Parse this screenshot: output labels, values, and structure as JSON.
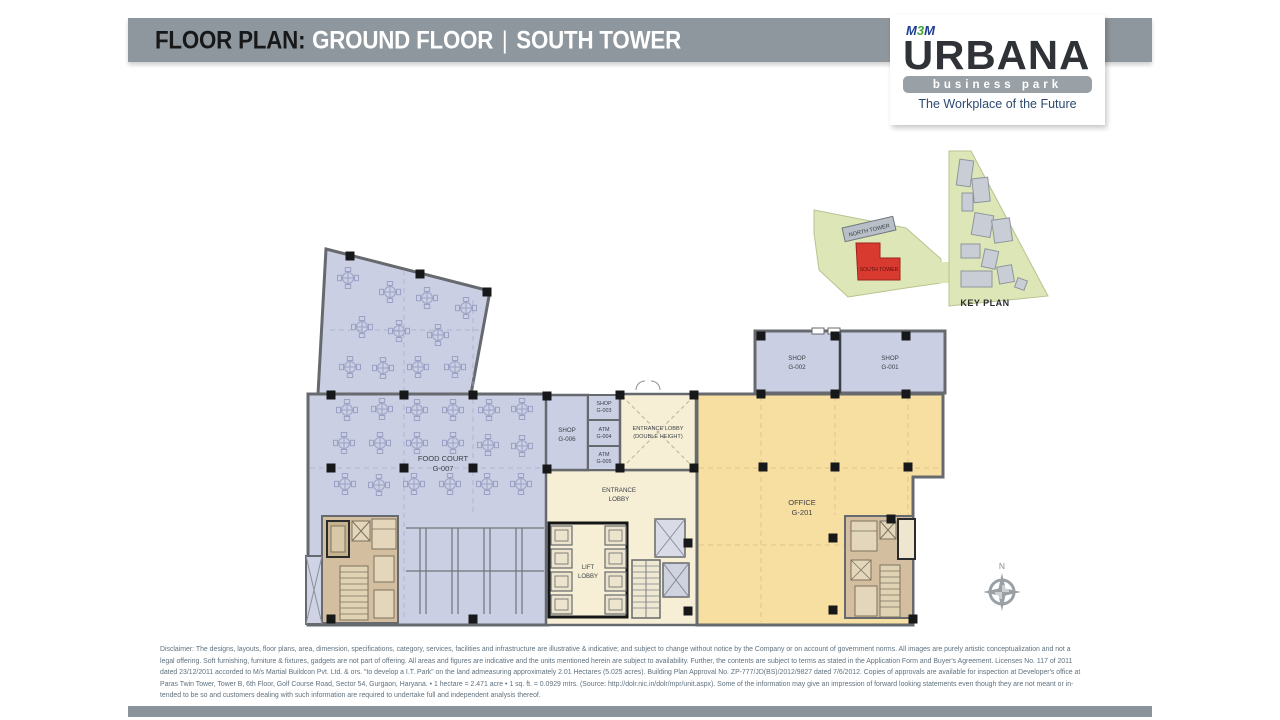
{
  "header": {
    "title_prefix": "FLOOR PLAN:",
    "title_main": "GROUND FLOOR",
    "separator": "|",
    "title_sub": "SOUTH TOWER"
  },
  "logo": {
    "brand_m1": "M",
    "brand_3": "3",
    "brand_m2": "M",
    "name": "URBANA",
    "subtitle": "business park",
    "tagline": "The Workplace of the Future"
  },
  "key_plan": {
    "label": "KEY PLAN",
    "north_tower": "NORTH TOWER",
    "south_tower": "SOUTH TOWER"
  },
  "plan": {
    "food_court": {
      "name": "FOOD COURT",
      "id": "G-007"
    },
    "shop_g006": {
      "name": "SHOP",
      "id": "G-006"
    },
    "shop_g003": {
      "name": "SHOP",
      "id": "G-003"
    },
    "atm_g004": {
      "name": "ATM",
      "id": "G-004"
    },
    "atm_g005": {
      "name": "ATM",
      "id": "G-005"
    },
    "entrance_lobby_dh": {
      "line1": "ENTRANCE LOBBY",
      "line2": "(DOUBLE HEIGHT)"
    },
    "entrance_lobby": {
      "line1": "ENTRANCE",
      "line2": "LOBBY"
    },
    "lift_lobby": {
      "line1": "LIFT",
      "line2": "LOBBY"
    },
    "office": {
      "name": "OFFICE",
      "id": "G-201"
    },
    "shop_g002": {
      "name": "SHOP",
      "id": "G-002"
    },
    "shop_g001": {
      "name": "SHOP",
      "id": "G-001"
    }
  },
  "compass": {
    "label": "N"
  },
  "disclaimer": {
    "lines": [
      "Disclaimer: The designs, layouts, floor plans, area, dimension, specifications, category, services, facilities and infrastructure are illustrative & indicative; and subject to change without notice by the Company or on account of government norms. All images are purely artistic conceptualization and not a",
      "legal offering. Soft furnishing, furniture & fixtures, gadgets are not part of offering. All areas and figures are indicative and the units mentioned herein are subject to availability. Further, the contents are subject to terms as stated in the Application Form and Buyer's Agreement. Licenses No. 117 of 2011",
      "dated 23/12/2011 accorded to M/s Martial Buildcon Pvt. Ltd. & ors. \"to develop a I.T. Park\" on the land admeasuring approximately 2.01 Hectares (5.025 acres). Building Plan Approval No. ZP-777/JD(BS)/2012/9827 dated 7/6/2012. Copies of approvals are available for inspection at Developer's office at",
      "Paras Twin Tower, Tower B, 6th Floor, Golf Course Road, Sector 54, Gurgaon, Haryana. • 1 hectare = 2.471 acre • 1 sq. ft. = 0.0929 mtrs. (Source: http://dolr.nic.in/dolr/mpr/unit.aspx). Some of the information may give an impression of forward looking statements even though they are not meant or in-",
      "tended to be so and customers dealing with such information are required to undertake full and independent analysis thereof."
    ]
  },
  "colors": {
    "header_gray": "#8e979d",
    "retail_purple": "#cbcfe3",
    "office_yellow": "#f7dfa1",
    "lobby_cream": "#f6efd6",
    "core_tan": "#d3bf9f",
    "keyplan_green": "#dce6b7",
    "south_tower_red": "#d93a30"
  }
}
